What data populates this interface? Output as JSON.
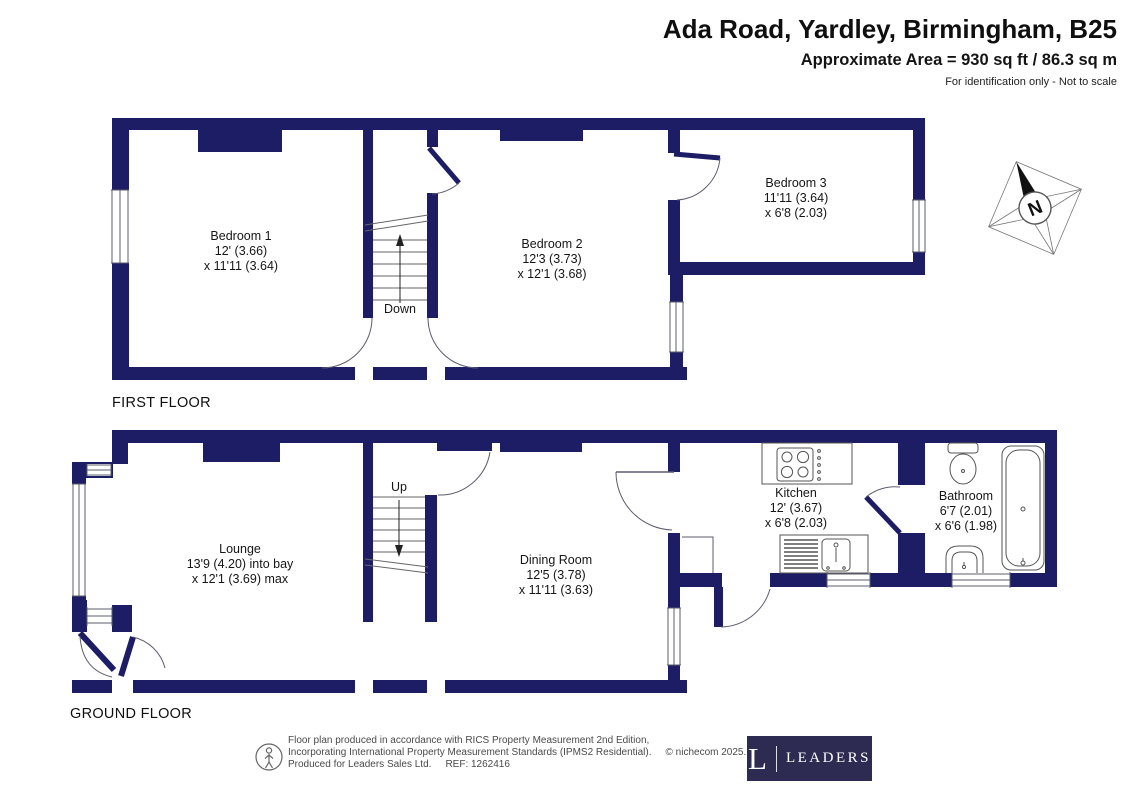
{
  "header": {
    "title": "Ada Road, Yardley, Birmingham, B25",
    "area": "Approximate Area = 930 sq ft / 86.3 sq m",
    "disclaimer": "For identification only - Not to scale"
  },
  "floors": {
    "first": {
      "label": "FIRST FLOOR",
      "stair_direction": "Down"
    },
    "ground": {
      "label": "GROUND FLOOR",
      "stair_direction": "Up"
    }
  },
  "rooms": {
    "bedroom1": {
      "name": "Bedroom 1",
      "dim1": "12' (3.66)",
      "dim2": "x 11'11 (3.64)"
    },
    "bedroom2": {
      "name": "Bedroom 2",
      "dim1": "12'3 (3.73)",
      "dim2": "x 12'1 (3.68)"
    },
    "bedroom3": {
      "name": "Bedroom 3",
      "dim1": "11'11 (3.64)",
      "dim2": "x 6'8 (2.03)"
    },
    "lounge": {
      "name": "Lounge",
      "dim1": "13'9 (4.20) into bay",
      "dim2": "x 12'1 (3.69) max"
    },
    "dining": {
      "name": "Dining Room",
      "dim1": "12'5 (3.78)",
      "dim2": "x 11'11 (3.63)"
    },
    "kitchen": {
      "name": "Kitchen",
      "dim1": "12' (3.67)",
      "dim2": "x 6'8 (2.03)"
    },
    "bathroom": {
      "name": "Bathroom",
      "dim1": "6'7 (2.01)",
      "dim2": "x 6'6 (1.98)"
    }
  },
  "compass": {
    "label": "N"
  },
  "footer": {
    "line1": "Floor plan produced in accordance with RICS Property Measurement 2nd Edition,",
    "line2": "Incorporating International Property Measurement Standards (IPMS2 Residential).",
    "copyright": "© nichecom 2025.",
    "line3": "Produced for Leaders Sales Ltd.",
    "ref": "REF: 1262416",
    "logo_letter": "L",
    "logo_text": "LEADERS"
  },
  "colors": {
    "wall": "#1d1d66",
    "line": "#5c5c6e",
    "logo_bg": "#2d2b52"
  }
}
